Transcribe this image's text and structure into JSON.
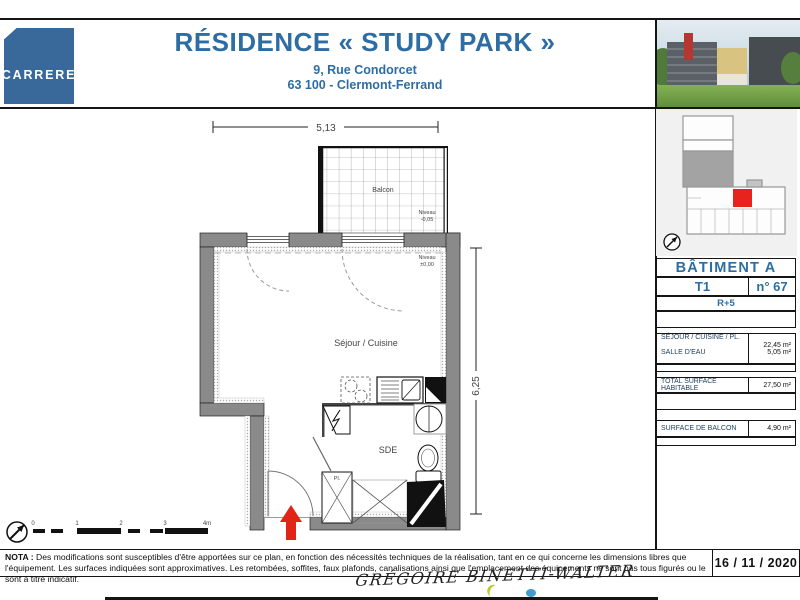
{
  "brand": {
    "logo_text": "CARRERE"
  },
  "header": {
    "title": "RÉSIDENCE « STUDY PARK »",
    "address_line1": "9, Rue Condorcet",
    "address_line2": "63 100 - Clermont-Ferrand"
  },
  "colors": {
    "brand_blue": "#2d6da3",
    "logo_blue": "#39699b",
    "unit_red": "#e8231c",
    "wall_grey": "#8a8a8a"
  },
  "plan": {
    "dim_width": "5,13",
    "dim_height": "6,25",
    "rooms": {
      "balcony": "Balcon",
      "living": "Séjour / Cuisine",
      "bathroom": "SDE",
      "closet": "Pl."
    },
    "levels": {
      "label": "Niveau",
      "balcony_value": "-0,05",
      "interior_value": "±0,00"
    },
    "scale_ticks": [
      "0",
      "1",
      "2",
      "3",
      "4m"
    ]
  },
  "sidebar": {
    "building_title": "BÂTIMENT A",
    "unit_type": "T1",
    "unit_number": "n° 67",
    "floor": "R+5",
    "areas": [
      {
        "label": "SÉJOUR / CUISINE / PL.",
        "value": "22,45 m²"
      },
      {
        "label": "SALLE D'EAU",
        "value": "5,05 m²"
      }
    ],
    "total": {
      "label": "TOTAL SURFACE HABITABLE",
      "value": "27,50 m²"
    },
    "balcony": {
      "label": "SURFACE DE BALCON",
      "value": "4,90 m²"
    }
  },
  "footer": {
    "nota_label": "NOTA :",
    "nota_line1": "Des modifications sont susceptibles d'être apportées sur ce plan, en fonction des nécessités techniques de la réalisation, tant en ce qui concerne les dimensions libres que l'équipement.",
    "nota_line2": "Les surfaces indiquées sont approximatives. Les retombées, soffites, faux plafonds, canalisations ainsi que l'emplacement des équipements ne sont pas tous figurés ou le sont à titre indicatif.",
    "date": "16 / 11 / 2020",
    "watermark": "GRÉGOIRE BINETTI-WALTER"
  }
}
